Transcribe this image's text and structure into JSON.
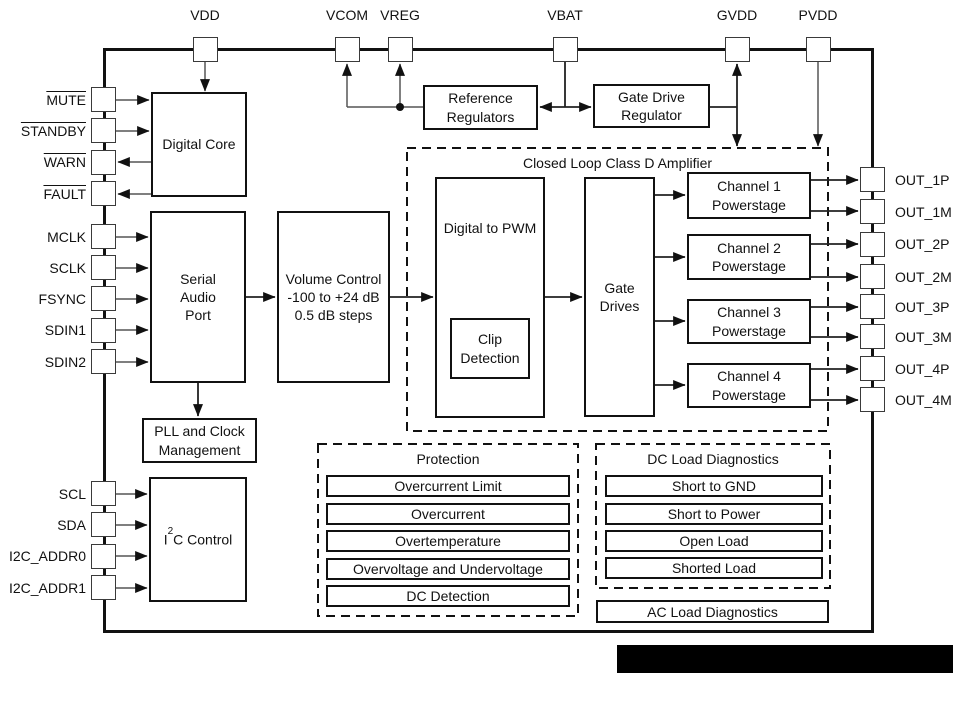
{
  "pins": {
    "top": [
      "VDD",
      "VCOM",
      "VREG",
      "VBAT",
      "GVDD",
      "PVDD"
    ],
    "left": [
      "MUTE",
      "STANDBY",
      "WARN",
      "FAULT",
      "MCLK",
      "SCLK",
      "FSYNC",
      "SDIN1",
      "SDIN2",
      "SCL",
      "SDA",
      "I2C_ADDR0",
      "I2C_ADDR1"
    ],
    "right": [
      "OUT_1P",
      "OUT_1M",
      "OUT_2P",
      "OUT_2M",
      "OUT_3P",
      "OUT_3M",
      "OUT_4P",
      "OUT_4M"
    ]
  },
  "blocks": {
    "digital_core": {
      "label": "Digital Core"
    },
    "serial_audio_port": {
      "lines": [
        "Serial",
        "Audio",
        "Port"
      ]
    },
    "volume_control": {
      "lines": [
        "Volume Control",
        "-100 to +24 dB",
        "0.5 dB steps"
      ]
    },
    "pll": {
      "lines": [
        "PLL and Clock",
        "Management"
      ]
    },
    "i2c_control": {
      "base": "I",
      "sup": "2",
      "rest": "C Control"
    },
    "reference_regulators": {
      "lines": [
        "Reference",
        "Regulators"
      ]
    },
    "gate_drive_regulator": {
      "lines": [
        "Gate Drive",
        "Regulator"
      ]
    },
    "closed_loop": {
      "title": "Closed Loop Class D Amplifier"
    },
    "digital_to_pwm": {
      "label": "Digital to PWM"
    },
    "clip_detection": {
      "lines": [
        "Clip",
        "Detection"
      ]
    },
    "gate_drives": {
      "lines": [
        "Gate",
        "Drives"
      ]
    },
    "channels": [
      {
        "lines": [
          "Channel 1",
          "Powerstage"
        ]
      },
      {
        "lines": [
          "Channel 2",
          "Powerstage"
        ]
      },
      {
        "lines": [
          "Channel 3",
          "Powerstage"
        ]
      },
      {
        "lines": [
          "Channel 4",
          "Powerstage"
        ]
      }
    ],
    "protection": {
      "title": "Protection",
      "items": [
        "Overcurrent Limit",
        "Overcurrent",
        "Overtemperature",
        "Overvoltage and Undervoltage",
        "DC Detection"
      ]
    },
    "dc_load_diagnostics": {
      "title": "DC Load Diagnostics",
      "items": [
        "Short to GND",
        "Short to Power",
        "Open Load",
        "Shorted Load"
      ]
    },
    "ac_load_diagnostics": {
      "label": "AC Load Diagnostics"
    }
  },
  "colors": {
    "block_border": "#111111",
    "connector": "#555555",
    "connector_bold": "#222222",
    "text": "#111111",
    "redaction": "#000000",
    "background": "#ffffff"
  }
}
